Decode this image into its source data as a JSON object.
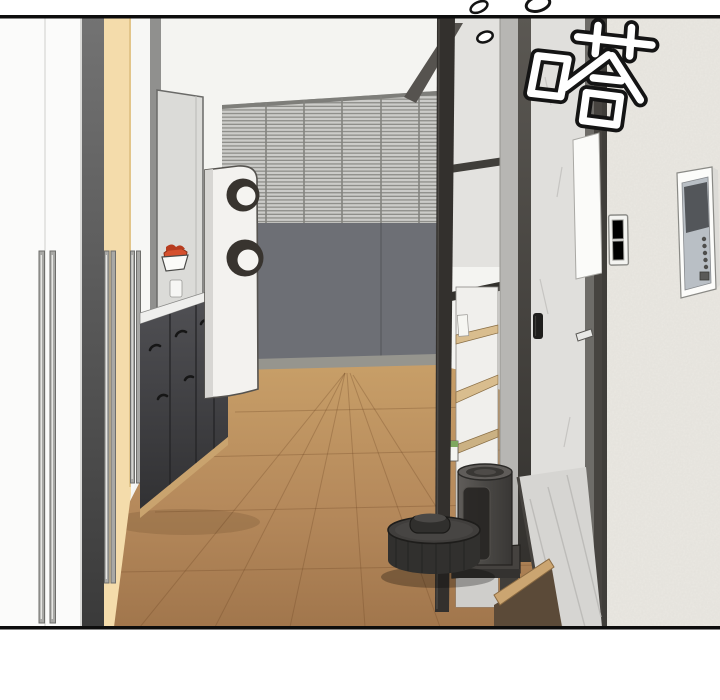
{
  "panel": {
    "sfx_text": "嗒",
    "margin_color": "#ffffff",
    "border_color": "#0d0d0d"
  },
  "scene": {
    "objects": [
      {
        "name": "closet-door-white",
        "color": "#fbfbfa"
      },
      {
        "name": "closet-door-dark",
        "color": "#4a4a4a"
      },
      {
        "name": "closet-door-cream",
        "color": "#f4dcab"
      },
      {
        "name": "door-handles",
        "color": "#9a9a97"
      },
      {
        "name": "kitchen-tall-cabinet",
        "color": "#dbdbd8"
      },
      {
        "name": "kitchen-lower-cabinets",
        "color": "#46464a"
      },
      {
        "name": "countertop",
        "color": "#efefed"
      },
      {
        "name": "food-bowl",
        "color": "#d5502e"
      },
      {
        "name": "speaker-tower",
        "color": "#f3f2ef"
      },
      {
        "name": "window-blinds",
        "color": "#cbcbc8"
      },
      {
        "name": "lower-wall",
        "color": "#6d6f75"
      },
      {
        "name": "wood-floor",
        "color": "#b78a58"
      },
      {
        "name": "shelf-frame",
        "color": "#33302d"
      },
      {
        "name": "shelf-unit",
        "color": "#f0efec"
      },
      {
        "name": "bathroom-door-marble",
        "color": "#e0dfdc"
      },
      {
        "name": "door-handle-recessed",
        "color": "#1f1e1c"
      },
      {
        "name": "right-wall",
        "color": "#eae8e2"
      },
      {
        "name": "light-switch",
        "color": "#f4f4f1"
      },
      {
        "name": "intercom-screen",
        "color": "#53565a"
      },
      {
        "name": "robot-vacuum",
        "color": "#353432"
      },
      {
        "name": "vacuum-dock",
        "color": "#4e4c4a"
      }
    ]
  }
}
